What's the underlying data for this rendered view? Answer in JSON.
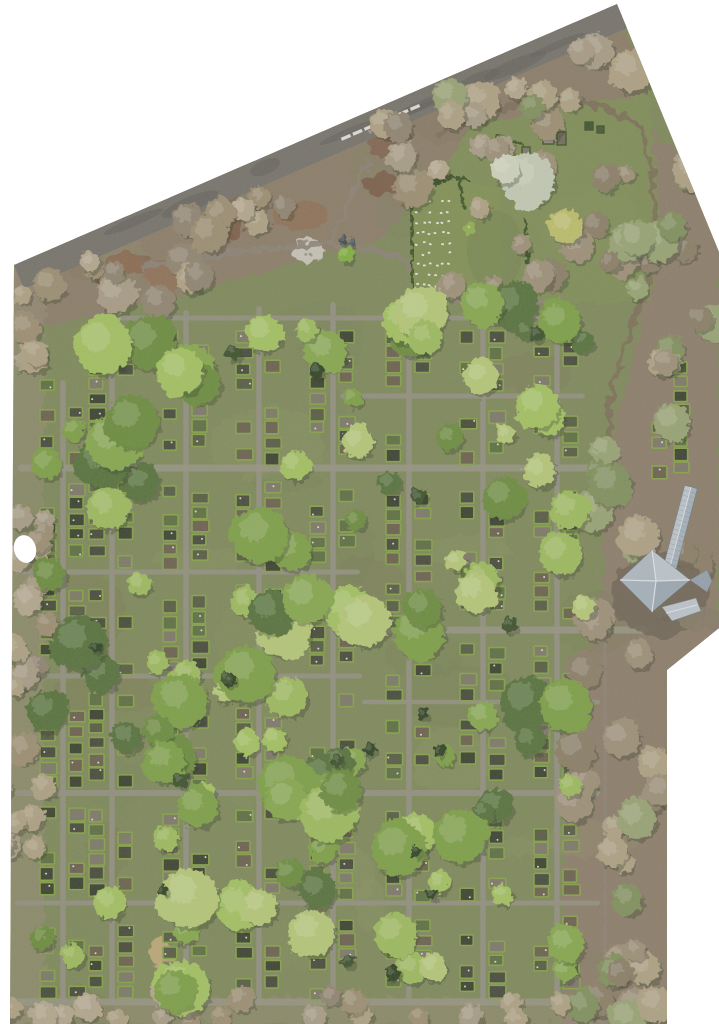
{
  "scene": {
    "type": "aerial-orthophoto",
    "subject": "cemetery with tree canopies, grave plot grid, memorial lawn and chapel roof",
    "width": 719,
    "height": 1024,
    "background": "#ffffff",
    "boundary": "14,265 617,4 719,252 719,628 667,670 667,1024 10,1024",
    "top_edge": {
      "x1": 14,
      "y1": 265,
      "x2": 617,
      "y2": 4
    },
    "hole": {
      "cx": 25,
      "cy": 549,
      "rx": 11,
      "ry": 14,
      "rot": -15
    },
    "palette": {
      "base_grass": "#7d8759",
      "right_strip": "#8b7c69",
      "upper_quad": "#7e8c56",
      "rough_band": "#8a7b68",
      "road": "#75716b",
      "road_blotch": "#5f5c57",
      "trail": "#8b8176",
      "dirt_trail": "#7b6d58",
      "path": "#918e80",
      "path_wide": "#95927f",
      "hedge": "#84a147",
      "hedge_dark": "#3d5226",
      "plot_fills": [
        "#45483a",
        "#7c7767",
        "#5c6d41",
        "#393f2f",
        "#6a5f4e",
        "#555a42"
      ],
      "plot_dot": "#e8e6da",
      "lawn": "#808f53",
      "lawn_light": "#8aa055",
      "stone": "#e9e7e0",
      "tree_greens": [
        "#9cba5d",
        "#85a74e",
        "#7c9f44",
        "#6a8b3d",
        "#54703a",
        "#a2c161",
        "#b4c777"
      ],
      "tree_pale": [
        "#a79b85",
        "#b3a68d",
        "#8f8370",
        "#9b8d72",
        "#ada083"
      ],
      "tree_mixed": [
        "#9c8f77",
        "#ada083",
        "#8a7d66",
        "#7f8f5c",
        "#97a273"
      ],
      "conifer": [
        "#3b4f2c",
        "#2f4023"
      ],
      "tree_shadow": "#2c3320",
      "mottle": [
        "#6d7a4e",
        "#8f9465",
        "#75805a",
        "#9aa06d",
        "#7b6b55"
      ],
      "red_soil": [
        "#7d5a46",
        "#8f6b50",
        "#75503d"
      ],
      "debris": "#c7c2b7",
      "crosswalk": "#e8e8e4",
      "roof_light": "#bcc5cd",
      "roof_mid": "#a5b1bb",
      "roof_dark": "#93a0ac",
      "roof_nw": "#aeb8c1",
      "roof_ne": "#bcc5cd",
      "roof_se": "#9aa7b2",
      "roof_sw": "#a5b0bb",
      "roof_ridge": "#dde3e8",
      "roof_seam": "#7f8b96",
      "roof_edge": "#6f7b86",
      "building_ground": "#6e6455",
      "building_apron": "#857a68",
      "straw_mound": "#c2ab7a"
    },
    "regions": {
      "right_strip_poly": "585,60 719,200 719,1024 562,1024 566,660 600,640 606,460 640,330 648,200 620,95",
      "upper_quad_poly": "428,190 470,125 560,106 648,95 660,210 650,300 560,305 470,300 432,300",
      "rough_band_poly": "14,265 617,4 648,95 560,106 470,125 428,190 380,240 300,262 180,295 90,318 14,332",
      "left_strip": {
        "x": 0,
        "y": 264,
        "w": 44,
        "h": 760,
        "color": "#968a74",
        "opacity": 0.55
      },
      "bottom_strip": {
        "x": 8,
        "y": 998,
        "w": 600,
        "h": 26,
        "color": "#968a74",
        "opacity": 0.5
      }
    },
    "road": {
      "width": 24,
      "blotches": 9,
      "seed": 31
    },
    "crosswalk": {
      "x0": 346,
      "count": 7,
      "step": 11.5,
      "dash_w": 3.2,
      "dash_h": 10,
      "y_offset": 16,
      "angle": 67
    },
    "trails": [
      {
        "pts": "140,268 240,252 330,243 400,256 428,292",
        "w": 5,
        "c": "trail"
      },
      {
        "pts": "330,243 352,196 368,162",
        "w": 4,
        "c": "trail"
      },
      {
        "pts": "428,292 470,300 530,303 560,300",
        "w": 5,
        "c": "trail"
      },
      {
        "pts": "403,186 403,298",
        "w": 4,
        "c": "path"
      },
      {
        "pts": "440,133 480,115 523,103 560,100 600,106 640,125",
        "w": 6,
        "c": "dirt_trail"
      },
      {
        "pts": "640,125 652,170 655,220 648,280 630,330 612,390 607,450",
        "w": 5,
        "c": "dirt_trail"
      },
      {
        "pts": "605,640 604,760 606,880 605,1015",
        "w": 8,
        "c": "trail"
      }
    ],
    "paths": {
      "vertical": [
        {
          "x": 63,
          "y1": 380,
          "y2": 1005,
          "w": 5.5
        },
        {
          "x": 112,
          "y1": 318,
          "y2": 1005,
          "w": 5.5
        },
        {
          "x": 186,
          "y1": 310,
          "y2": 1005,
          "w": 5.5
        },
        {
          "x": 259,
          "y1": 306,
          "y2": 1005,
          "w": 5.5
        },
        {
          "x": 333,
          "y1": 302,
          "y2": 1005,
          "w": 5.5
        },
        {
          "x": 409,
          "y1": 300,
          "y2": 1005,
          "w": 5.5
        },
        {
          "x": 483,
          "y1": 300,
          "y2": 1005,
          "w": 5.5
        },
        {
          "x": 557,
          "y1": 300,
          "y2": 1005,
          "w": 5.5
        }
      ],
      "horizontal": [
        {
          "y": 318,
          "x1": 95,
          "x2": 560,
          "w": 5
        },
        {
          "y": 396,
          "x1": 340,
          "x2": 585,
          "w": 5
        },
        {
          "y": 468,
          "x1": 18,
          "x2": 600,
          "w": 7
        },
        {
          "y": 572,
          "x1": 15,
          "x2": 360,
          "w": 5
        },
        {
          "y": 630,
          "x1": 360,
          "x2": 648,
          "w": 7
        },
        {
          "y": 676,
          "x1": 15,
          "x2": 362,
          "w": 5
        },
        {
          "y": 702,
          "x1": 362,
          "x2": 600,
          "w": 4.5
        },
        {
          "y": 793,
          "x1": 15,
          "x2": 600,
          "w": 6
        },
        {
          "y": 903,
          "x1": 15,
          "x2": 600,
          "w": 5
        },
        {
          "y": 1002,
          "x1": 12,
          "x2": 610,
          "w": 7
        }
      ]
    },
    "plots": {
      "col_w": 17,
      "row_step": 15,
      "skip": 0.34,
      "dot_chance": 0.4,
      "seed": 77,
      "extra_cols": [
        {
          "x": 652,
          "w": 16,
          "y1": 362,
          "y2": 470
        },
        {
          "x": 674,
          "w": 16,
          "y1": 362,
          "y2": 470
        }
      ]
    },
    "mottle": {
      "count": 46,
      "seed": 11,
      "x1": 14,
      "x2": 700,
      "y1": 95,
      "y2": 1020,
      "opacity": 0.16
    },
    "red_patches": {
      "count": 10,
      "seed": 21,
      "x1": 60,
      "x2": 420,
      "off1": 28,
      "off2": 85,
      "opacity": 0.65
    },
    "debris_pile": {
      "cx": 308,
      "cy": 251,
      "rx": 16,
      "ry": 11
    },
    "tree_regions": [
      {
        "kind": "band",
        "x1": 20,
        "x2": 600,
        "o1": 18,
        "o2": 100,
        "n": 34,
        "r1": 9,
        "r2": 20,
        "colors": "tree_pale",
        "seed": 1
      },
      {
        "kind": "rect",
        "x1": 585,
        "x2": 719,
        "y1": 60,
        "y2": 640,
        "n": 30,
        "r1": 10,
        "r2": 22,
        "colors": "tree_mixed",
        "seed": 2
      },
      {
        "kind": "rect",
        "x1": 565,
        "x2": 667,
        "y1": 640,
        "y2": 1024,
        "n": 26,
        "r1": 9,
        "r2": 20,
        "colors": "tree_mixed",
        "seed": 3
      },
      {
        "kind": "rect",
        "x1": 2,
        "x2": 48,
        "y1": 270,
        "y2": 1020,
        "n": 26,
        "r1": 8,
        "r2": 16,
        "colors": "tree_pale",
        "seed": 4
      },
      {
        "kind": "rect",
        "x1": 15,
        "x2": 600,
        "y1": 992,
        "y2": 1024,
        "n": 18,
        "r1": 8,
        "r2": 14,
        "colors": "tree_pale",
        "seed": 5
      },
      {
        "kind": "rect",
        "x1": 435,
        "x2": 640,
        "y1": 95,
        "y2": 300,
        "n": 20,
        "r1": 8,
        "r2": 18,
        "colors": "tree_mixed",
        "seed": 6
      },
      {
        "kind": "rect",
        "x1": 40,
        "x2": 595,
        "y1": 300,
        "y2": 1000,
        "n": 115,
        "r1": 9,
        "r2": 30,
        "colors": "tree_greens",
        "seed": 8
      },
      {
        "kind": "rect",
        "x1": 60,
        "x2": 580,
        "y1": 320,
        "y2": 990,
        "n": 18,
        "r1": 4.5,
        "r2": 8,
        "colors": "conifer",
        "seed": 9
      }
    ],
    "special_trees": [
      {
        "cx": 528,
        "cy": 180,
        "r": 27,
        "c": "#c3c9b4"
      },
      {
        "cx": 505,
        "cy": 170,
        "r": 14,
        "c": "#cdd2bd"
      },
      {
        "cx": 566,
        "cy": 226,
        "r": 17,
        "c": "#bcbd6a"
      },
      {
        "cx": 346,
        "cy": 255,
        "r": 8,
        "c": "#7fae3f"
      },
      {
        "cx": 344,
        "cy": 240,
        "r": 4,
        "c": "#3c4a52"
      },
      {
        "cx": 352,
        "cy": 243,
        "r": 3.5,
        "c": "#45545c"
      }
    ],
    "lawn": {
      "poly": "411,186 448,181 470,183 500,188 503,297 413,298",
      "shade": {
        "cx": 495,
        "cy": 250,
        "rx": 28,
        "ry": 40,
        "opacity": 0.35
      },
      "hedges": [
        "411,186 413,297",
        "411,186 446,181",
        "413,297 460,294",
        "497,137 523,144",
        "440,176 468,180",
        "458,176 464,207",
        "525,220 529,277"
      ],
      "stones": {
        "x0": 416,
        "y0": 201,
        "cols": 6,
        "rows": 9,
        "dx": 6.3,
        "dy": 10.4,
        "jitter": 1.3,
        "sw": 2.6,
        "sh": 1.8,
        "skip": 0.12,
        "seed": 55
      },
      "bush": {
        "cx": 470,
        "cy": 228,
        "r": 6.5,
        "c": "#8fae54"
      },
      "upper_graves": [
        {
          "x": 543,
          "y": 129,
          "w": 11,
          "h": 15,
          "c": "#8a8578"
        },
        {
          "x": 557,
          "y": 132,
          "w": 9,
          "h": 13,
          "c": "#6f6a5c"
        },
        {
          "x": 522,
          "y": 147,
          "w": 8,
          "h": 10,
          "c": "#7c7767"
        },
        {
          "x": 585,
          "y": 122,
          "w": 8,
          "h": 8,
          "c": "#3f512e"
        },
        {
          "x": 597,
          "y": 126,
          "w": 7,
          "h": 7,
          "c": "#46592f"
        }
      ]
    },
    "building": {
      "ground": {
        "cx": 660,
        "cy": 595,
        "rx": 48,
        "ry": 42
      },
      "apron": {
        "cx": 700,
        "cy": 618,
        "rx": 22,
        "ry": 13
      },
      "wing": {
        "x1": 691,
        "y1": 487,
        "x2": 670,
        "y2": 567,
        "w": 13,
        "seam_step": 5
      },
      "pavilion": {
        "cx": 656,
        "cy": 581,
        "west": "620,580",
        "north": "652,550",
        "east": "690,580",
        "south": "652,612"
      },
      "hip_east": "690,580 707,570 712,581 707,592",
      "annex_se": "662,607 696,598 701,611 672,621",
      "annex_ridge": "666,613 697,605"
    },
    "straw_mound": {
      "cx": 161,
      "cy": 953,
      "rx": 13,
      "ry": 15
    },
    "grain_opacity": 0.14
  }
}
